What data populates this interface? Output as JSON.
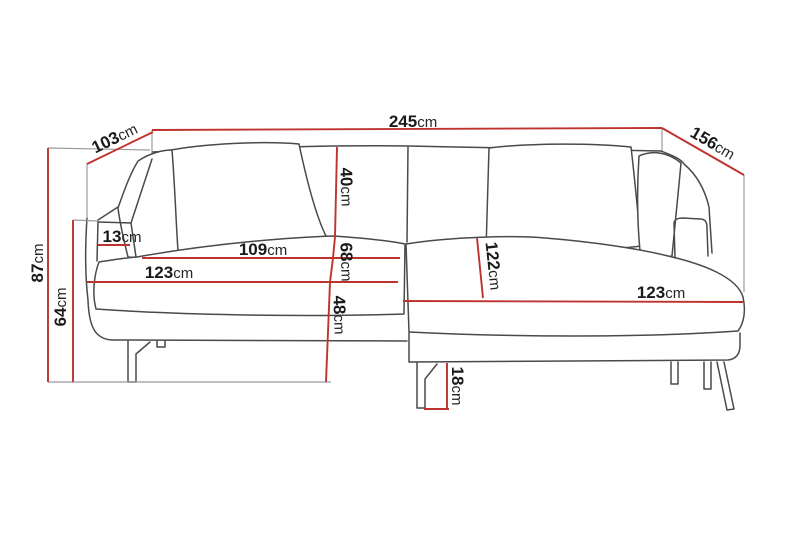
{
  "diagram": {
    "subject": "corner-sofa-with-chaise-dimension-drawing",
    "unit": "cm",
    "colors": {
      "dimension_line": "#bf332f",
      "artwork_line": "#4a4a4a",
      "helper_line": "#9b9b9b",
      "label_number": "#1a1a1a",
      "label_unit": "#242424",
      "background": "#ffffff"
    },
    "measurements": {
      "total_width": {
        "value": "245",
        "unit": "cm"
      },
      "depth_left": {
        "value": "103",
        "unit": "cm"
      },
      "depth_right": {
        "value": "156",
        "unit": "cm"
      },
      "height_total": {
        "value": "87",
        "unit": "cm"
      },
      "height_armrest": {
        "value": "64",
        "unit": "cm"
      },
      "armrest_width": {
        "value": "13",
        "unit": "cm"
      },
      "back_cushion": {
        "value": "40",
        "unit": "cm"
      },
      "seat_depth": {
        "value": "109",
        "unit": "cm"
      },
      "inner_depth": {
        "value": "68",
        "unit": "cm"
      },
      "seat_width_left": {
        "value": "123",
        "unit": "cm"
      },
      "seat_height": {
        "value": "48",
        "unit": "cm"
      },
      "chaise_length": {
        "value": "122",
        "unit": "cm"
      },
      "seat_width_right": {
        "value": "123",
        "unit": "cm"
      },
      "leg_height": {
        "value": "18",
        "unit": "cm"
      }
    }
  }
}
